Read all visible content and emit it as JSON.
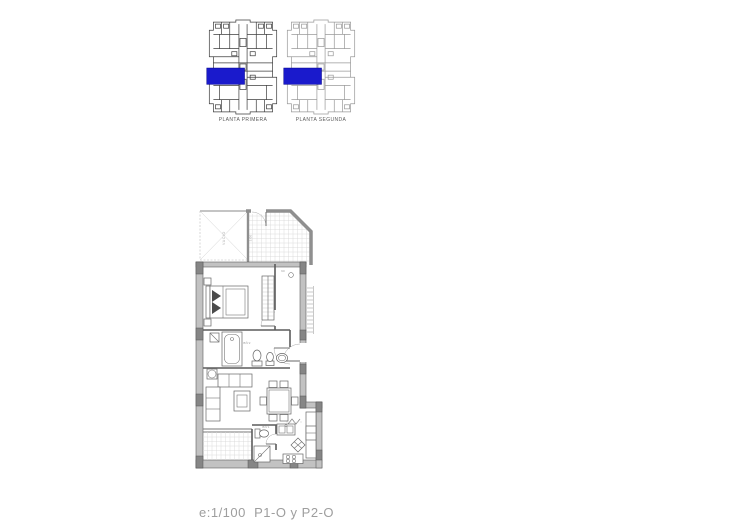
{
  "overview_plans": [
    {
      "label": "PLANTA PRIMERA"
    },
    {
      "label": "PLANTA SEGUNDA"
    }
  ],
  "apartment": {
    "void_label": "VACIO",
    "terrace_dim": "3.00",
    "door_dim": "90",
    "main_bath_label": "BÑ'2",
    "small_bath_label": "BÑ'1"
  },
  "caption": {
    "scale_text": "e:1/100  P1-O y P2-O"
  },
  "colors": {
    "highlight_blue": "#1a1acc",
    "thumb1_line": "#3f3f3f",
    "thumb2_line": "#9a9a9a"
  }
}
